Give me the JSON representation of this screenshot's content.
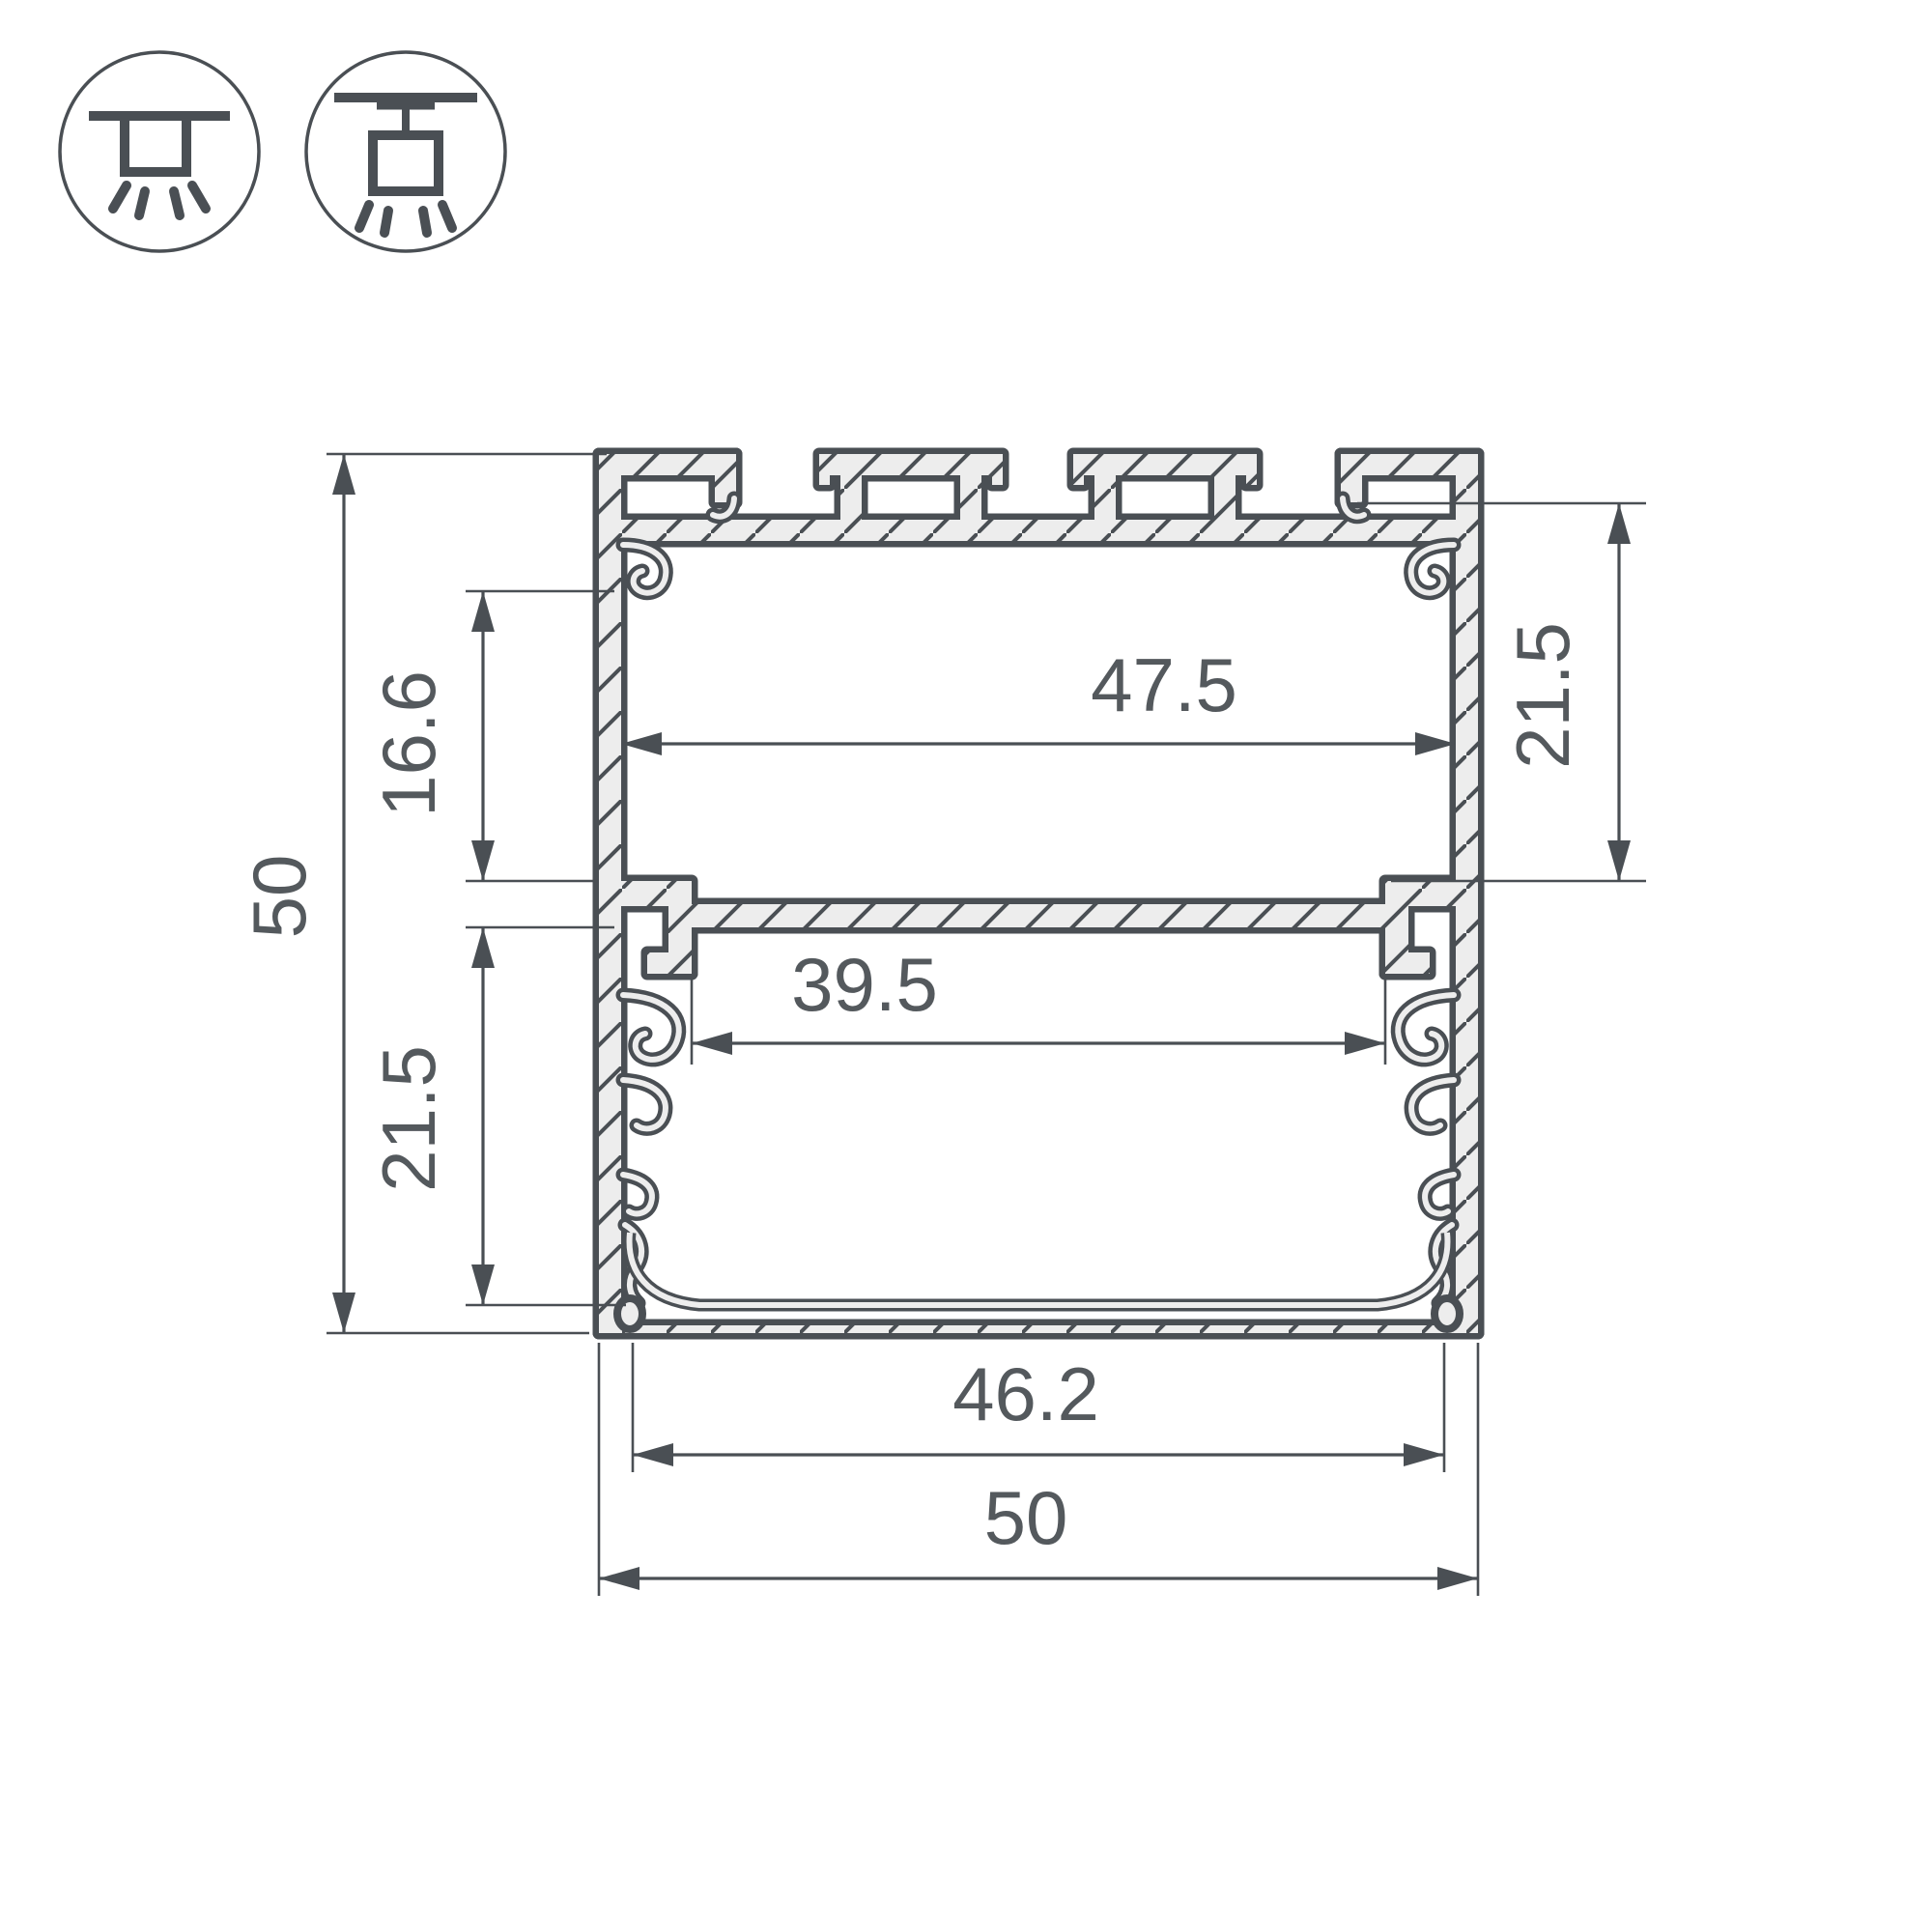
{
  "drawing_type": "profile-cross-section",
  "dimensions": {
    "overall_height": "50",
    "overall_width": "50",
    "inner_width": "47.5",
    "upper_cavity_height": "16.6",
    "lower_cavity_height": "21.5",
    "right_cavity_depth": "21.5",
    "led_slot_width": "39.5",
    "bottom_inner_width": "46.2"
  },
  "icons": {
    "left": "surface-ceiling-mount-icon",
    "right": "pendant-suspended-mount-icon"
  },
  "colors": {
    "line": "#4a4f54",
    "metal_fill": "#ededed",
    "text": "#54595d",
    "background": "#ffffff"
  }
}
